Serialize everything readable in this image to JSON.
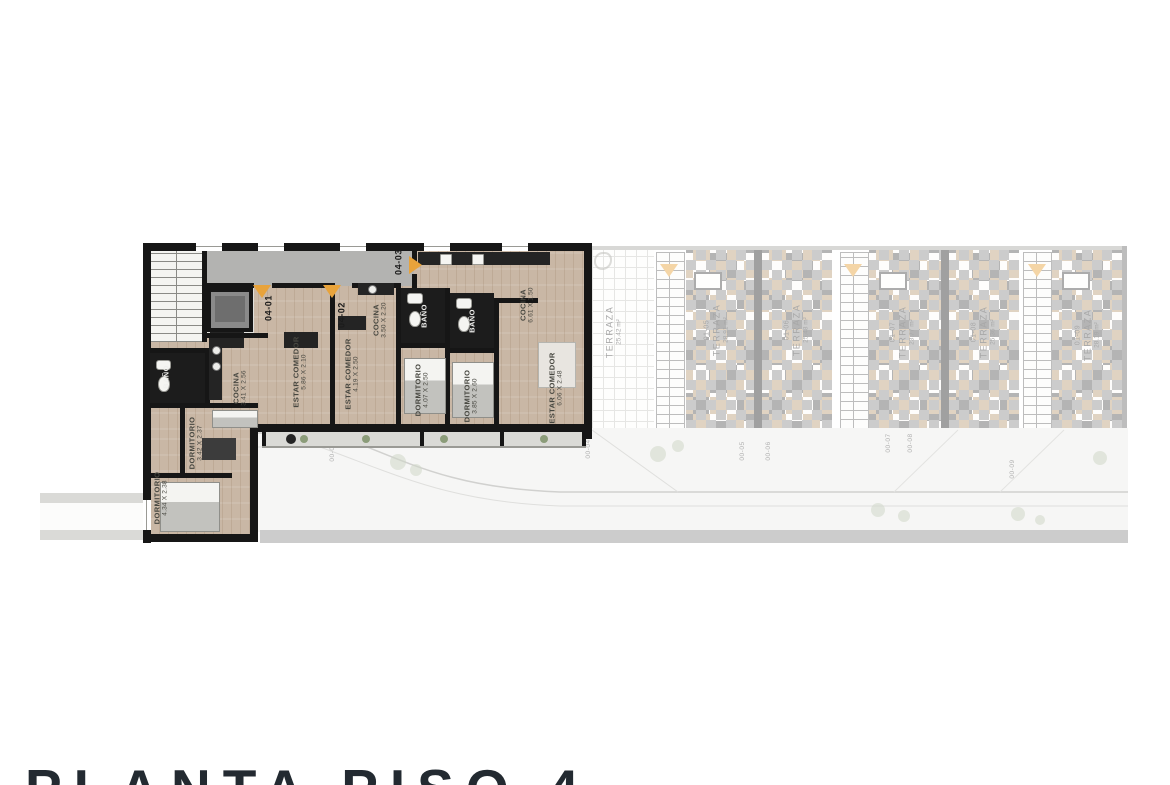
{
  "title": "PLANTA PISO 4",
  "colors": {
    "accent_orange": "#e8a33b",
    "wall_black": "#161616",
    "wood_floor": "#c9b7a5",
    "corridor_gray": "#b3b3b1"
  },
  "plan": {
    "units": [
      {
        "id": "04-01"
      },
      {
        "id": "04-02"
      },
      {
        "id": "04-03"
      }
    ],
    "rooms": [
      {
        "name": "BAÑO",
        "dims": ""
      },
      {
        "name": "COCINA",
        "dims": "3.41 X 2.56"
      },
      {
        "name": "ESTAR COMEDOR",
        "dims": "5.86 X 2.10"
      },
      {
        "name": "ESTAR COMEDOR",
        "dims": "4.19 X 2.50"
      },
      {
        "name": "COCINA",
        "dims": "3.50 X 2.20"
      },
      {
        "name": "BAÑO",
        "dims": ""
      },
      {
        "name": "DORMITORIO",
        "dims": "4.07 X 2.50"
      },
      {
        "name": "BAÑO",
        "dims": ""
      },
      {
        "name": "DORMITORIO",
        "dims": "3.85 X 2.60"
      },
      {
        "name": "COCINA",
        "dims": "6.61 X 1.50"
      },
      {
        "name": "ESTAR COMEDOR",
        "dims": "6.06 X 2.48"
      },
      {
        "name": "DORMITORIO",
        "dims": "3.42 X 2.37"
      },
      {
        "name": "DORMITORIO",
        "dims": "4.34 X 2.38"
      }
    ]
  },
  "terraces": [
    {
      "id": "",
      "name": "TERRAZA",
      "area": "25.42 m²"
    },
    {
      "id": "01-05",
      "name": "TERRAZA",
      "area": "28.91 m²"
    },
    {
      "id": "01-06",
      "name": "TERRAZA",
      "area": "25.48 m²"
    },
    {
      "id": "01-07",
      "name": "TERRAZA",
      "area": "23.77 m²"
    },
    {
      "id": "01-08",
      "name": "TERRAZA",
      "area": "25.36 m²"
    },
    {
      "id": "01-09",
      "name": "TERRAZA",
      "area": "28.19 m²"
    }
  ],
  "street_labels": [
    "00-03",
    "00-04",
    "00-05",
    "00-06",
    "00-07",
    "00-08",
    "00-09"
  ]
}
